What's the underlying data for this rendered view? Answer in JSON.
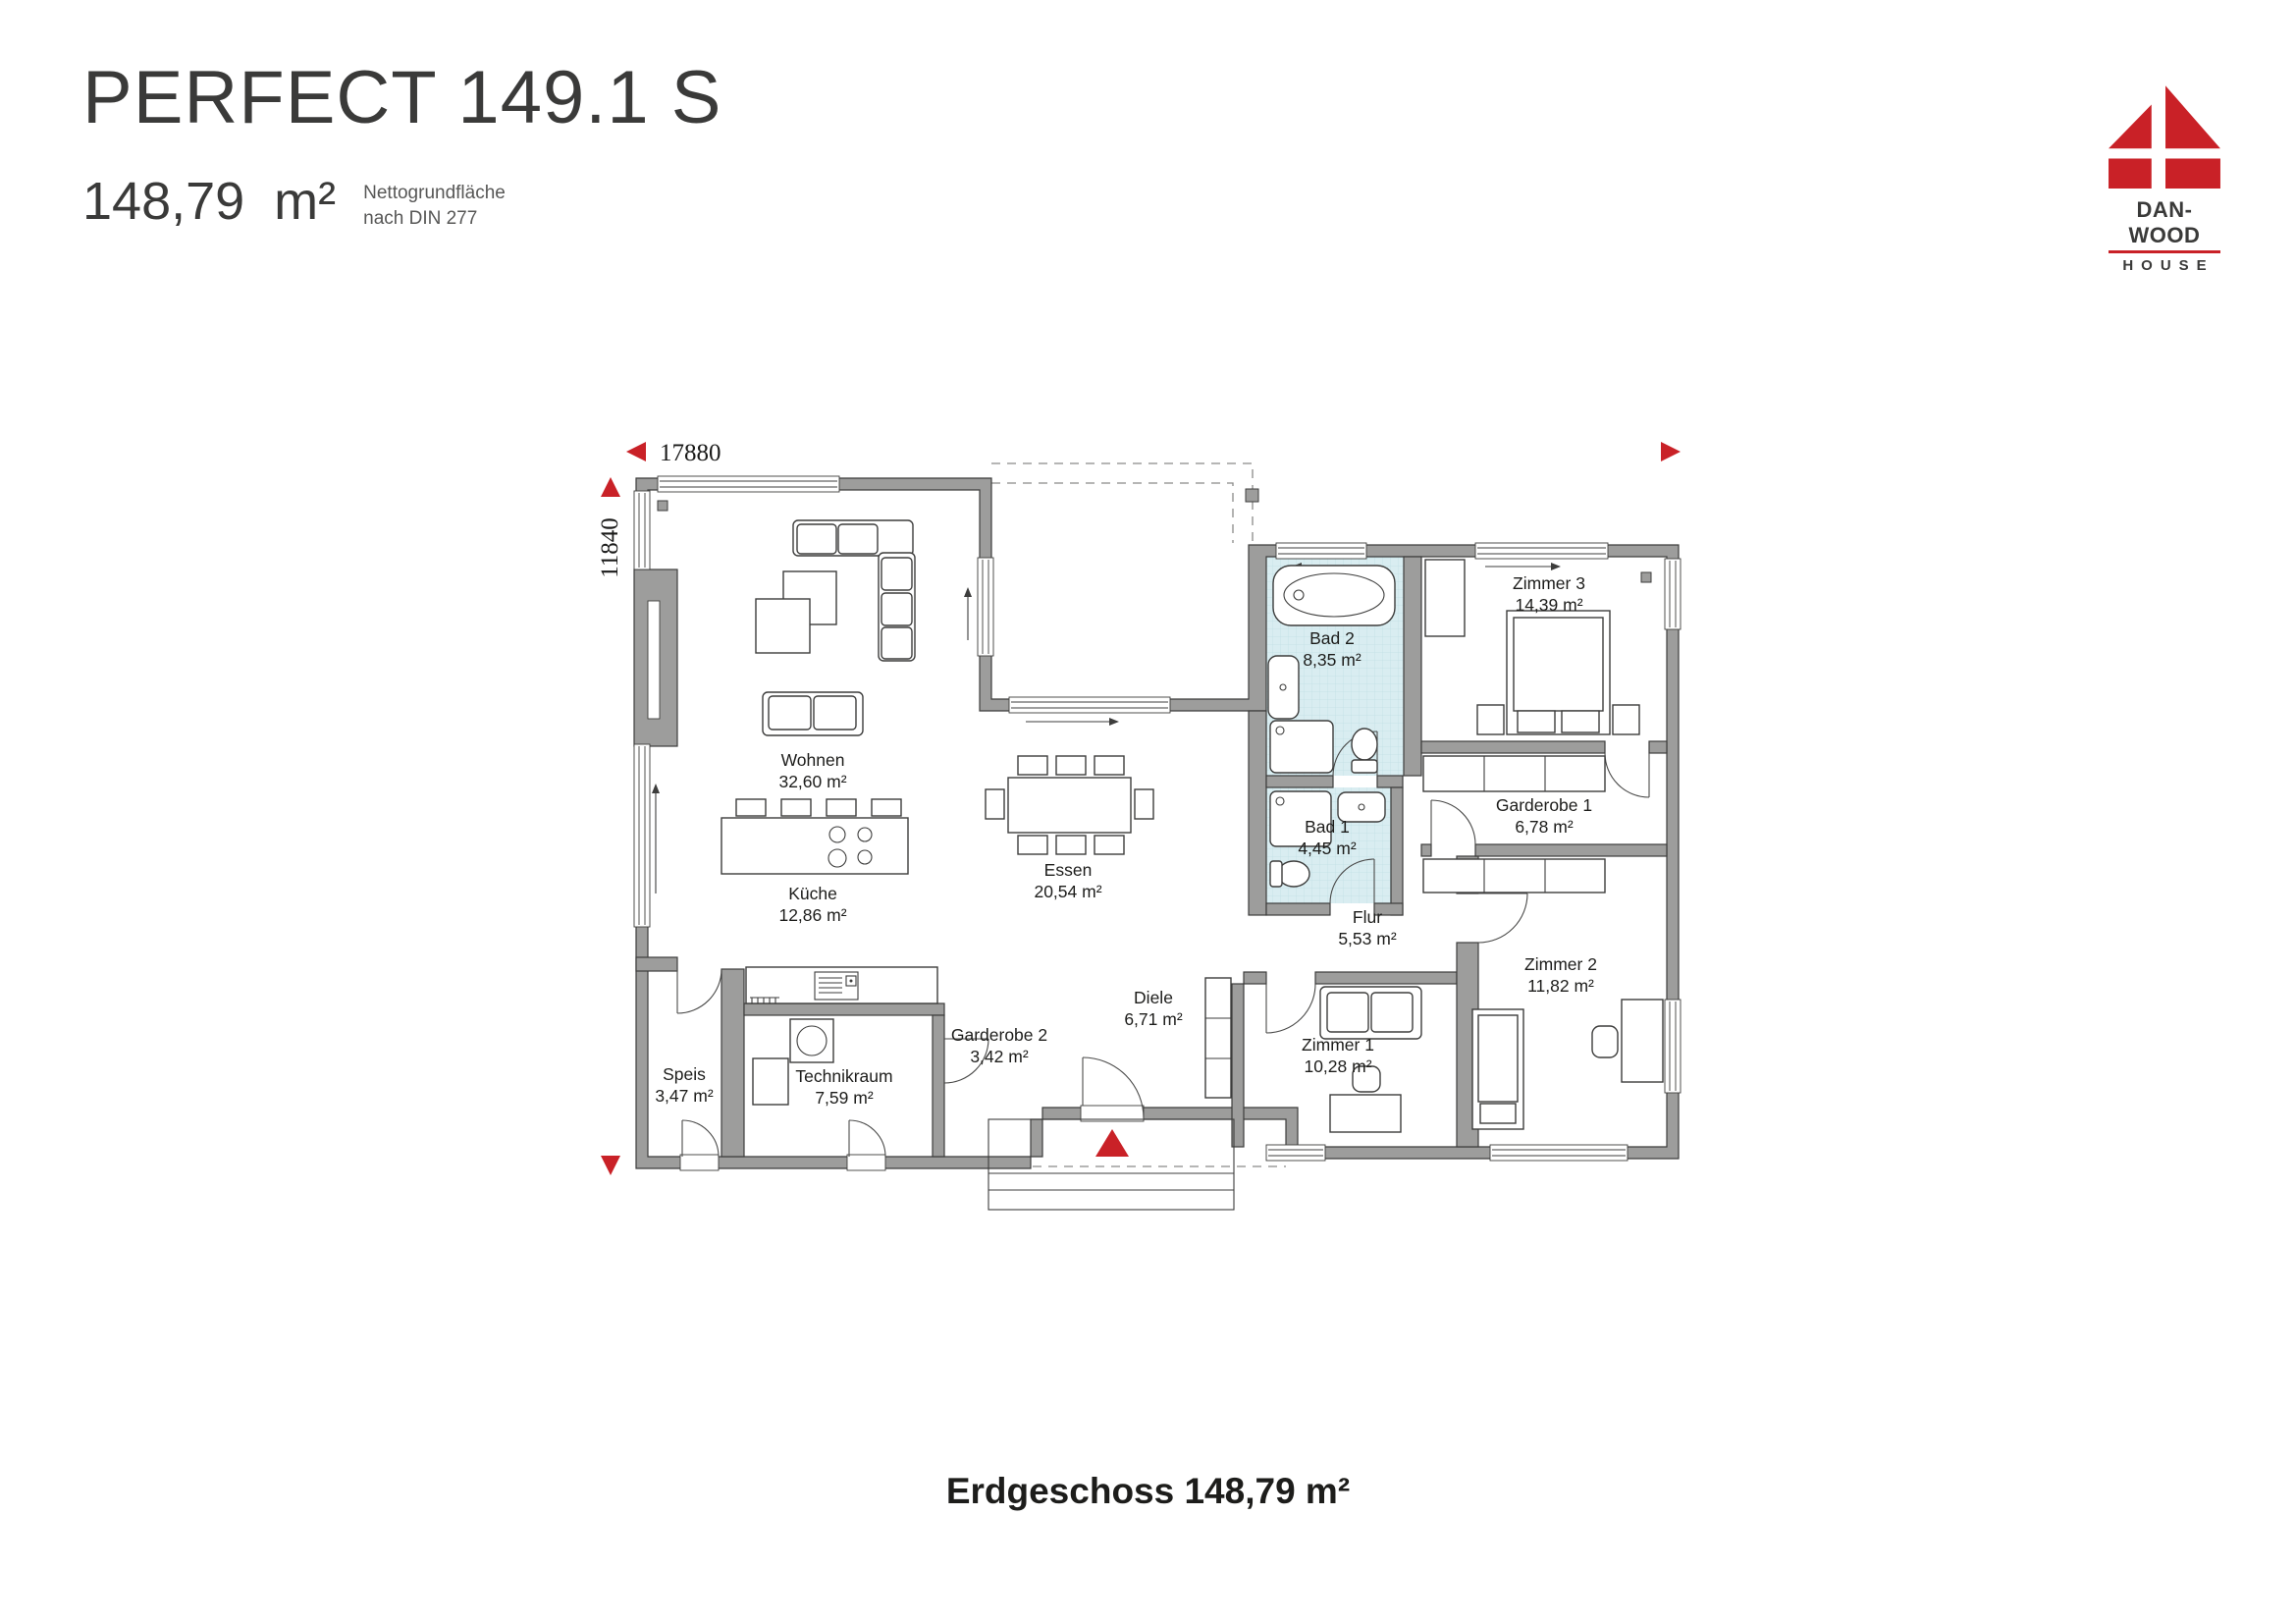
{
  "header": {
    "title": "PERFECT 149.1 S",
    "area_value": "148,79",
    "area_unit": "m²",
    "note_line1": "Nettogrundfläche",
    "note_line2": "nach DIN 277"
  },
  "logo": {
    "brand": "DAN-WOOD",
    "word": "HOUSE"
  },
  "dimensions": {
    "width": "17880",
    "depth": "11840"
  },
  "rooms": [
    {
      "id": "wohnen",
      "name": "Wohnen",
      "area": "32,60 m²"
    },
    {
      "id": "kueche",
      "name": "Küche",
      "area": "12,86 m²"
    },
    {
      "id": "essen",
      "name": "Essen",
      "area": "20,54 m²"
    },
    {
      "id": "bad2",
      "name": "Bad 2",
      "area": "8,35 m²"
    },
    {
      "id": "bad1",
      "name": "Bad 1",
      "area": "4,45 m²"
    },
    {
      "id": "zimmer3",
      "name": "Zimmer 3",
      "area": "14,39 m²"
    },
    {
      "id": "garderobe1",
      "name": "Garderobe 1",
      "area": "6,78 m²"
    },
    {
      "id": "flur",
      "name": "Flur",
      "area": "5,53 m²"
    },
    {
      "id": "zimmer2",
      "name": "Zimmer 2",
      "area": "11,82 m²"
    },
    {
      "id": "zimmer1",
      "name": "Zimmer 1",
      "area": "10,28 m²"
    },
    {
      "id": "diele",
      "name": "Diele",
      "area": "6,71 m²"
    },
    {
      "id": "garderobe2",
      "name": "Garderobe 2",
      "area": "3,42 m²"
    },
    {
      "id": "technikraum",
      "name": "Technikraum",
      "area": "7,59 m²"
    },
    {
      "id": "speis",
      "name": "Speis",
      "area": "3,47 m²"
    }
  ],
  "footer": {
    "label": "Erdgeschoss 148,79 m²"
  },
  "colors": {
    "brand_red": "#c92127",
    "wall_gray": "#9d9d9c",
    "tile_blue": "#d9edf1",
    "line": "#3d3d3c",
    "text": "#1d1d1b"
  }
}
